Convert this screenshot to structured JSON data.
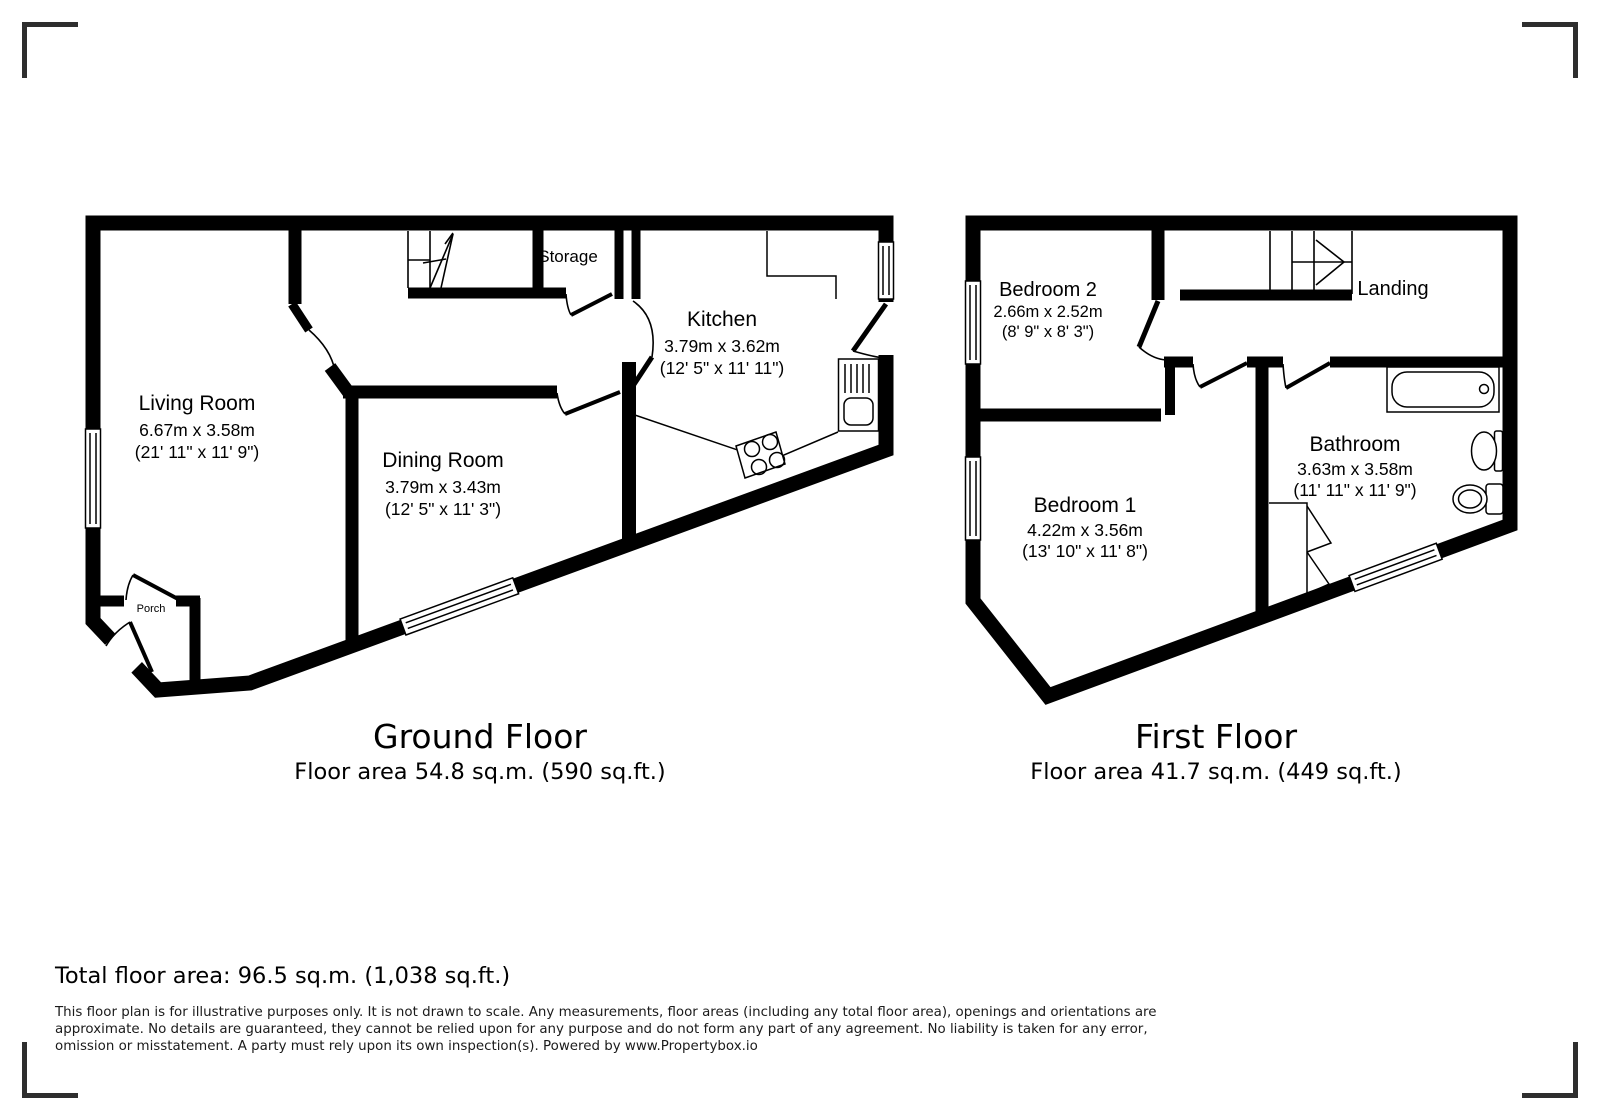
{
  "page": {
    "background": "#ffffff",
    "wall_color": "#000000",
    "bracket_color": "#2e2e2e"
  },
  "ground_floor": {
    "title": "Ground Floor",
    "area_label": "Floor area 54.8 sq.m. (590 sq.ft.)",
    "rooms": {
      "living_room": {
        "name": "Living Room",
        "dims_m": "6.67m x 3.58m",
        "dims_ft": "(21' 11\" x 11' 9\")"
      },
      "dining_room": {
        "name": "Dining Room",
        "dims_m": "3.79m x 3.43m",
        "dims_ft": "(12' 5\" x 11' 3\")"
      },
      "kitchen": {
        "name": "Kitchen",
        "dims_m": "3.79m x 3.62m",
        "dims_ft": "(12' 5\" x 11' 11\")"
      },
      "storage": {
        "name": "Storage"
      },
      "porch": {
        "name": "Porch"
      }
    }
  },
  "first_floor": {
    "title": "First Floor",
    "area_label": "Floor area 41.7 sq.m. (449 sq.ft.)",
    "rooms": {
      "bedroom_2": {
        "name": "Bedroom 2",
        "dims_m": "2.66m x 2.52m",
        "dims_ft": "(8' 9\" x 8' 3\")"
      },
      "landing": {
        "name": "Landing"
      },
      "bedroom_1": {
        "name": "Bedroom 1",
        "dims_m": "4.22m x 3.56m",
        "dims_ft": "(13' 10\" x 11' 8\")"
      },
      "bathroom": {
        "name": "Bathroom",
        "dims_m": "3.63m x 3.58m",
        "dims_ft": "(11' 11\" x 11' 9\")"
      }
    }
  },
  "footer": {
    "total_area": "Total floor area: 96.5 sq.m. (1,038 sq.ft.)",
    "disclaimer_lines": [
      "This floor plan is for illustrative purposes only. It is not drawn to scale. Any measurements, floor areas (including any total floor area), openings and orientations are",
      "approximate. No details are guaranteed, they cannot be relied upon for any purpose and do not form any part of any agreement. No liability is taken for any error,",
      "omission or misstatement. A party must rely upon its own inspection(s). Powered by www.Propertybox.io"
    ]
  }
}
